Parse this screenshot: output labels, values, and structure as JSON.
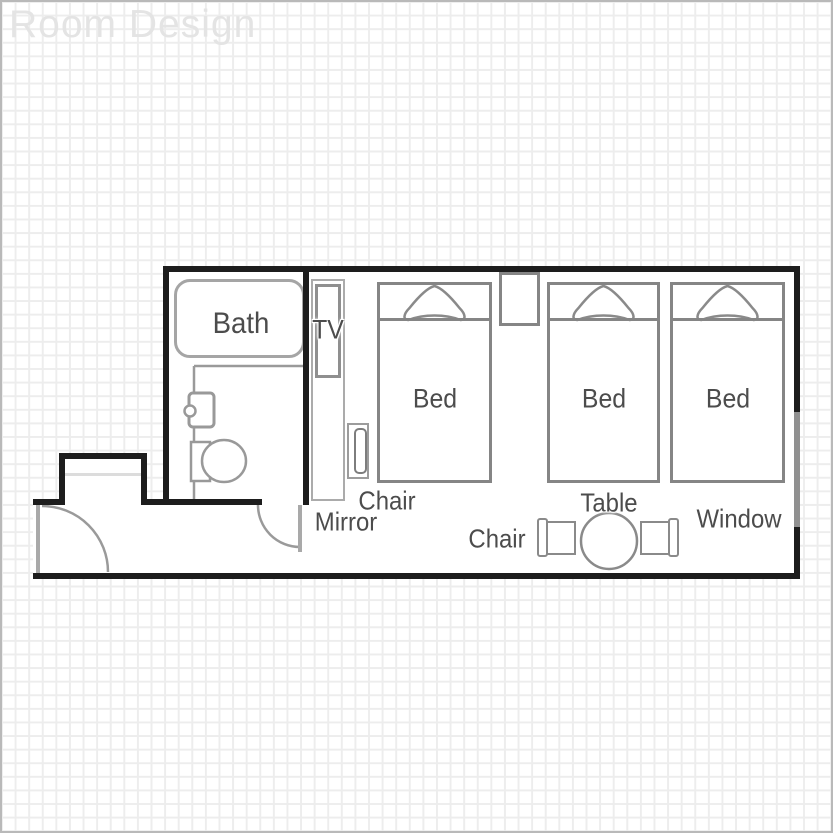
{
  "title": "Room Design",
  "plan": {
    "labels": {
      "bath": "Bath",
      "tv": "TV",
      "beds": [
        "Bed",
        "Bed",
        "Bed"
      ],
      "desk_chair": "Chair",
      "mirror": "Mirror",
      "dining_chair": "Chair",
      "table": "Table",
      "window": "Window"
    },
    "colors": {
      "wall": "#1d1d1d",
      "window_wall": "#909090",
      "furniture_line": "#8a8a8a",
      "light_line": "#a5a5a5",
      "door_line": "#a9a9a9",
      "label_text": "#4c4c4c",
      "title_text": "#e4e4e4",
      "grid_line": "#ededed",
      "background": "#ffffff"
    }
  }
}
